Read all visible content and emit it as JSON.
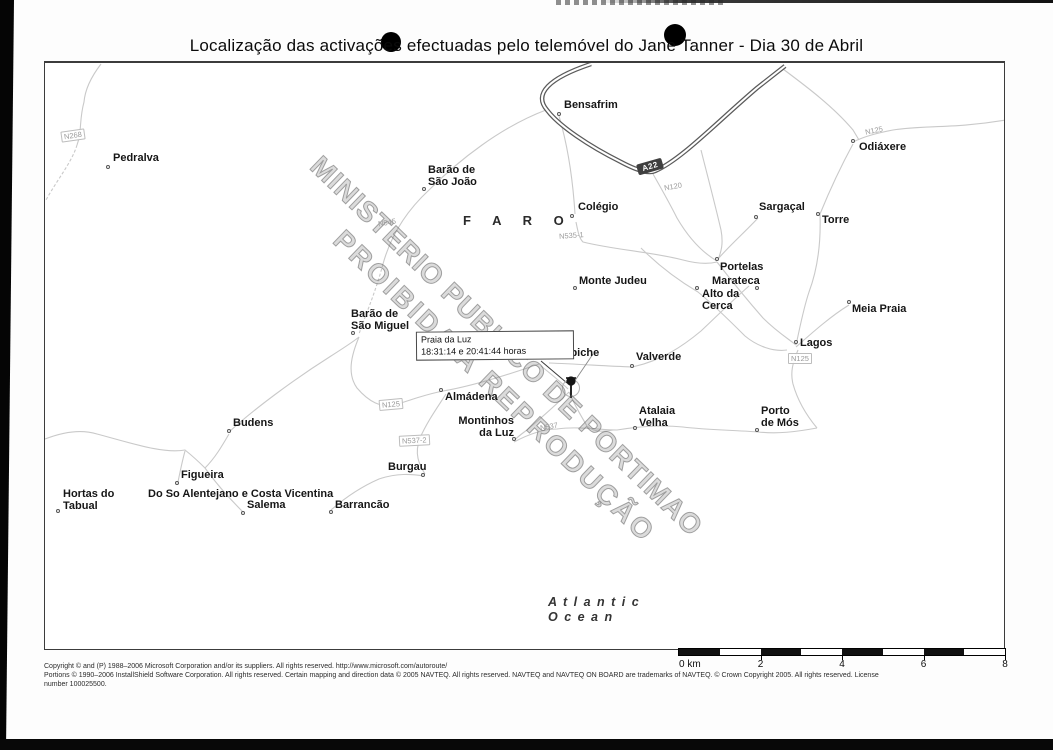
{
  "title": "Localização das activações efectuadas pelo telemóvel do Jane Tanner - Dia 30 de Abril",
  "map": {
    "region_label": "F A R O",
    "ocean": {
      "line1": "A t l a n t i c",
      "line2": "O c e a n"
    },
    "watermark": {
      "line1": "MINISTERIO PUBLICO DE PORTIMAO",
      "line2": "PROIBIDA A REPRODUÇÃO"
    },
    "callout": {
      "title": "Praia da Luz",
      "times": "18:31:14 e 20:41:44 horas"
    },
    "highway_shield": "A22",
    "places": [
      {
        "lines": [
          "Pedralva"
        ],
        "x": 112,
        "y": 151,
        "marker": {
          "x": 107,
          "y": 165
        }
      },
      {
        "lines": [
          "Bensafrim"
        ],
        "x": 563,
        "y": 98,
        "marker": {
          "x": 558,
          "y": 112
        }
      },
      {
        "lines": [
          "Barão de",
          "São João"
        ],
        "x": 427,
        "y": 163,
        "marker": {
          "x": 423,
          "y": 187
        }
      },
      {
        "lines": [
          "Odiáxere"
        ],
        "x": 858,
        "y": 140,
        "marker": {
          "x": 852,
          "y": 139
        }
      },
      {
        "lines": [
          "Colégio"
        ],
        "x": 577,
        "y": 200,
        "marker": {
          "x": 571,
          "y": 214
        }
      },
      {
        "lines": [
          "Sargaçal"
        ],
        "x": 758,
        "y": 200,
        "marker": {
          "x": 755,
          "y": 215
        }
      },
      {
        "lines": [
          "Torre"
        ],
        "x": 821,
        "y": 213,
        "marker": {
          "x": 817,
          "y": 212
        }
      },
      {
        "lines": [
          "Portelas"
        ],
        "x": 719,
        "y": 260,
        "marker": {
          "x": 716,
          "y": 257
        }
      },
      {
        "lines": [
          "Monte Judeu"
        ],
        "x": 578,
        "y": 274,
        "marker": {
          "x": 574,
          "y": 286
        }
      },
      {
        "lines": [
          "Marateca"
        ],
        "x": 711,
        "y": 274,
        "marker": {
          "x": 756,
          "y": 286
        }
      },
      {
        "lines": [
          "Alto da",
          "Cerca"
        ],
        "x": 701,
        "y": 287,
        "marker": {
          "x": 696,
          "y": 286
        }
      },
      {
        "lines": [
          "Meia Praia"
        ],
        "x": 851,
        "y": 302,
        "marker": {
          "x": 848,
          "y": 300
        }
      },
      {
        "lines": [
          "Lagos"
        ],
        "x": 799,
        "y": 336,
        "marker": {
          "x": 795,
          "y": 340
        }
      },
      {
        "lines": [
          "Barão de",
          "São Miguel"
        ],
        "x": 350,
        "y": 307,
        "marker": {
          "x": 352,
          "y": 331
        }
      },
      {
        "lines": [
          "Espiche"
        ],
        "x": 556,
        "y": 346,
        "marker": {
          "x": 536,
          "y": 355
        }
      },
      {
        "lines": [
          "Valverde"
        ],
        "x": 635,
        "y": 350,
        "marker": {
          "x": 631,
          "y": 364
        }
      },
      {
        "lines": [
          "Almádena"
        ],
        "x": 444,
        "y": 390,
        "marker": {
          "x": 440,
          "y": 388
        }
      },
      {
        "lines": [
          "Atalaia",
          "Velha"
        ],
        "x": 638,
        "y": 404,
        "marker": {
          "x": 634,
          "y": 426
        }
      },
      {
        "lines": [
          "Porto",
          "de Mós"
        ],
        "x": 760,
        "y": 404,
        "marker": {
          "x": 756,
          "y": 428
        }
      },
      {
        "lines": [
          "Budens"
        ],
        "x": 232,
        "y": 416,
        "marker": {
          "x": 228,
          "y": 429
        }
      },
      {
        "lines": [
          "Montinhos",
          "da Luz"
        ],
        "x": 513,
        "y": 414,
        "align": "right",
        "marker": {
          "x": 513,
          "y": 437
        }
      },
      {
        "lines": [
          "Burgau"
        ],
        "x": 387,
        "y": 460,
        "marker": {
          "x": 422,
          "y": 473
        }
      },
      {
        "lines": [
          "Figueira"
        ],
        "x": 180,
        "y": 468,
        "marker": {
          "x": 176,
          "y": 481
        }
      },
      {
        "lines": [
          "Hortas do",
          "Tabual"
        ],
        "x": 62,
        "y": 487,
        "marker": {
          "x": 57,
          "y": 509
        }
      },
      {
        "lines": [
          "Do So Alentejano e Costa Vicentina"
        ],
        "x": 147,
        "y": 487
      },
      {
        "lines": [
          "Salema"
        ],
        "x": 246,
        "y": 498,
        "marker": {
          "x": 242,
          "y": 511
        }
      },
      {
        "lines": [
          "Barrancão"
        ],
        "x": 334,
        "y": 498,
        "marker": {
          "x": 330,
          "y": 510
        }
      }
    ],
    "road_labels": [
      {
        "text": "N268",
        "x": 60,
        "y": 128,
        "rot": -8,
        "boxed": true
      },
      {
        "text": "N545",
        "x": 377,
        "y": 216,
        "rot": -10,
        "boxed": false
      },
      {
        "text": "N125",
        "x": 864,
        "y": 124,
        "rot": -12,
        "boxed": false
      },
      {
        "text": "N120",
        "x": 663,
        "y": 180,
        "rot": -10,
        "boxed": false
      },
      {
        "text": "N535-1",
        "x": 558,
        "y": 229,
        "rot": -4,
        "boxed": false
      },
      {
        "text": "N125",
        "x": 787,
        "y": 351,
        "rot": 0,
        "boxed": true
      },
      {
        "text": "N125",
        "x": 378,
        "y": 397,
        "rot": -5,
        "boxed": true
      },
      {
        "text": "N537-2",
        "x": 398,
        "y": 433,
        "rot": -3,
        "boxed": true
      },
      {
        "text": "N537",
        "x": 539,
        "y": 420,
        "rot": -10,
        "boxed": false
      }
    ]
  },
  "scalebar": {
    "km_total": 8,
    "tick_values": [
      0,
      2,
      4,
      6,
      8
    ],
    "tick_labels": [
      "0 km",
      "2",
      "4",
      "6",
      "8"
    ]
  },
  "footer": {
    "line1": "Copyright © and (P) 1988–2006 Microsoft Corporation and/or its suppliers. All rights reserved. http://www.microsoft.com/autoroute/",
    "line2": "Portions © 1990–2006 InstallShield Software Corporation. All rights reserved. Certain mapping and direction data © 2005 NAVTEQ. All rights reserved. NAVTEQ and NAVTEQ ON BOARD are trademarks of NAVTEQ. © Crown Copyright 2005. All rights reserved. License",
    "line3": "number 100025500."
  }
}
